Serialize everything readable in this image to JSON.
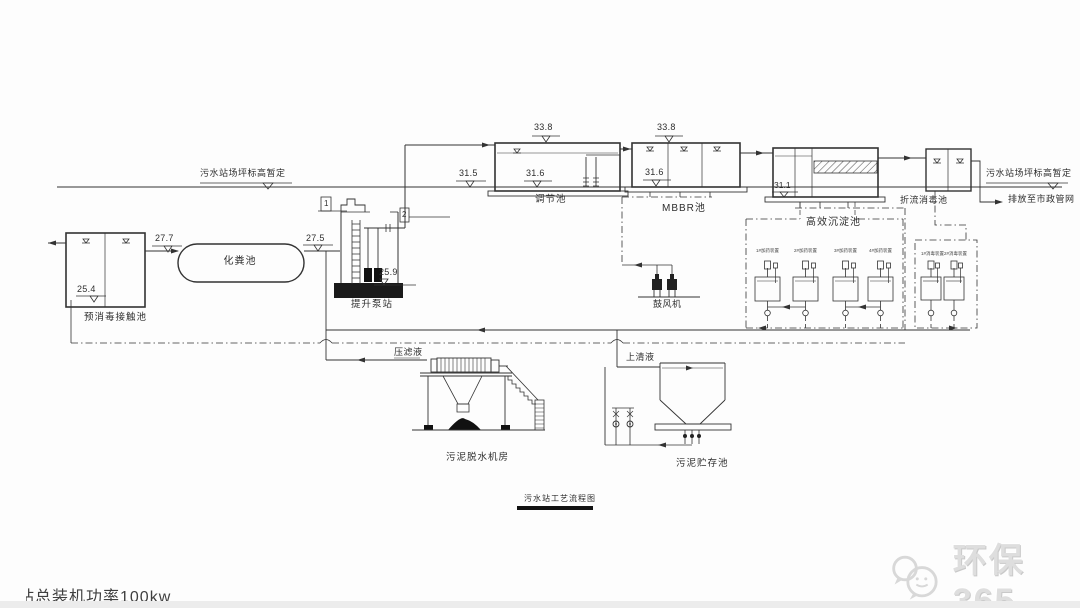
{
  "drawing": {
    "ground_left_label": "污水站场坪标高暂定",
    "ground_right_label": "污水站场坪标高暂定",
    "discharge_label": "排放至市政管网",
    "title": "污水站工艺流程图",
    "power_note": "总装机功率100kw",
    "power_note_clipped_prefix": "站",
    "watermark_text": "环保365",
    "units": {
      "pre_contact": {
        "label": "预消毒接触池",
        "elev": "25.4"
      },
      "septic": {
        "label": "化粪池",
        "elev_in": "27.7",
        "elev_out": "27.5"
      },
      "lift": {
        "label": "提升泵站",
        "elev": "25.9",
        "tag1": "1",
        "tag2": "2"
      },
      "regulating": {
        "label": "调节池",
        "elev_top": "33.8",
        "elev_bot": "31.6",
        "elev_ground": "31.5"
      },
      "mbbr": {
        "label": "MBBR池",
        "elev_top": "33.8",
        "elev_bot": "31.6"
      },
      "sedimentation": {
        "label": "高效沉淀池",
        "elev": "31.1"
      },
      "baffled": {
        "label": "折流消毒池"
      },
      "blower": {
        "label": "鼓风机"
      },
      "dewatering": {
        "label": "污泥脱水机房",
        "filtrate_label": "压滤液"
      },
      "sludge_storage": {
        "label": "污泥贮存池",
        "supernatant_label": "上清液"
      },
      "dosing_left": {
        "labels": [
          "1#加药装置",
          "2#加药装置",
          "3#加药装置",
          "4#加药装置"
        ]
      },
      "dosing_right": {
        "labels": [
          "1#消毒装置",
          "2#消毒装置"
        ]
      }
    }
  }
}
